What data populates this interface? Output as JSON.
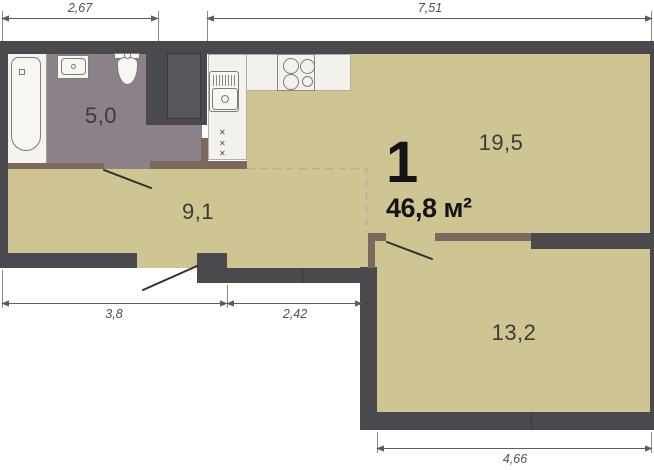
{
  "unit": {
    "number": "1",
    "area_label": "46,8 м²"
  },
  "rooms": [
    {
      "id": "bathroom",
      "area": "5,0"
    },
    {
      "id": "hallway",
      "area": "9,1"
    },
    {
      "id": "kitchen-living",
      "area": "19,5"
    },
    {
      "id": "bedroom",
      "area": "13,2"
    }
  ],
  "dimensions": {
    "top_left": "2,67",
    "top_right": "7,51",
    "bottom_left": "3,8",
    "bottom_mid": "2,42",
    "bedroom_bottom": "4,66"
  },
  "symbols": {
    "appliance_mark": "✕"
  },
  "colors": {
    "wall": "#4a494d",
    "partition": "#7b695d",
    "floor_main": "#cfc593",
    "floor_bathroom": "#8d8189",
    "fixture_white": "#f4f3f0",
    "shaft_inner": "#57565a",
    "dashed_zone_line": "#b7ae96",
    "dimension_line": "#6b6b6b",
    "label_text": "#3b3b3b",
    "title_text": "#141414"
  }
}
